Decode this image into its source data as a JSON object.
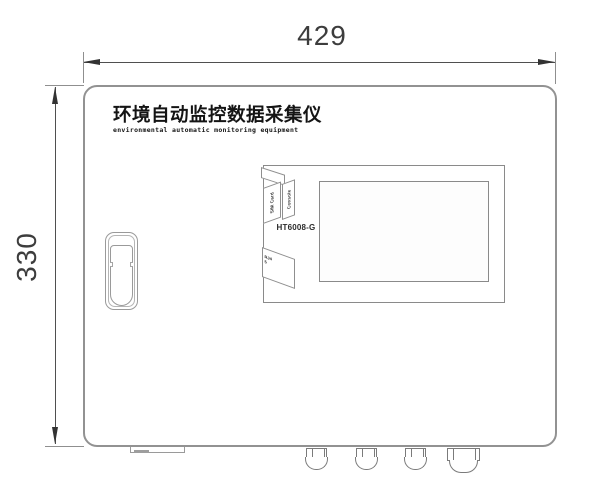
{
  "drawing": {
    "dimensions": {
      "width_label": "429",
      "height_label": "330"
    },
    "device": {
      "title_cn": "环境自动监控数据采集仪",
      "title_en": "environmental automatic monitoring equipment",
      "model": "HT6008-G",
      "labels": {
        "sim_card": "SIM Card",
        "console": "Console",
        "port": "RJ45"
      }
    },
    "colors": {
      "outline": "#929292",
      "dimension_line": "#4f4f4f",
      "arrow": "#333333",
      "text": "#141414",
      "background": "#ffffff"
    }
  }
}
